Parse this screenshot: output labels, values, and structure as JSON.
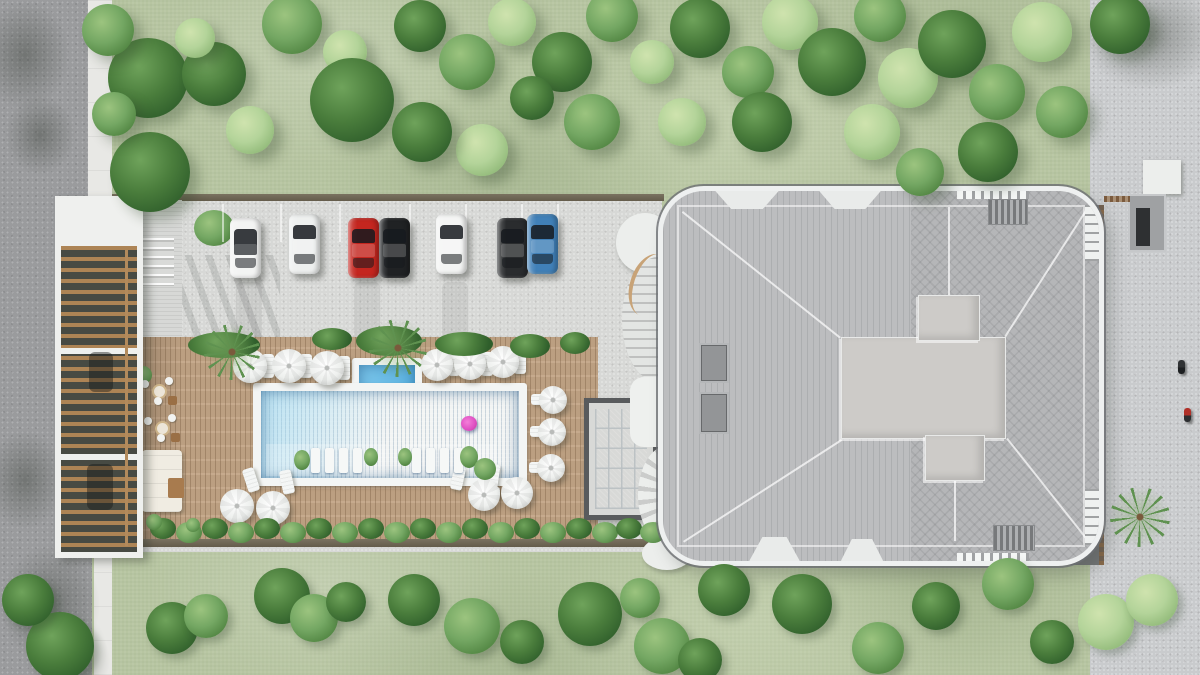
{
  "image": {
    "type": "architectural-aerial-render",
    "title": "residential-complex-site-plan-top-view",
    "width": 1200,
    "height": 675
  },
  "palette": {
    "road": "#9a9b9d",
    "sidewalk": "#e8e8e5",
    "lawn": "#b7c5a1",
    "parking": "#d7d8d6",
    "pavement": "#c9cbcd",
    "deck_wood": "#c3a586",
    "pool_water": "#4aa5d8",
    "pool_coping": "#f3f5f4",
    "kids_pool_water": "#66bbe6",
    "glass_pool": "#4e9bcd",
    "roof": "#bcbdbf",
    "roof_plateau": "#cdcbc8",
    "roof_trim": "#ffffff",
    "pergola_wood": "#ad8455",
    "dark_path": "#747678",
    "tree_dark": "#4a7d3c",
    "tree_mid": "#74a763",
    "tree_light": "#b4d49a",
    "float_pink": "#e052c4"
  },
  "parking": {
    "cars": [
      {
        "name": "white-convertible",
        "color": "#f3f4f3",
        "x": 230,
        "y": 218,
        "open_top": true
      },
      {
        "name": "white-sedan-1",
        "color": "#eef0ef",
        "x": 289,
        "y": 214
      },
      {
        "name": "red-sedan",
        "color": "#c4261f",
        "x": 348,
        "y": 218
      },
      {
        "name": "black-suv-1",
        "color": "#202224",
        "x": 379,
        "y": 218
      },
      {
        "name": "white-sedan-2",
        "color": "#f4f5f4",
        "x": 436,
        "y": 214
      },
      {
        "name": "black-suv-2",
        "color": "#2a2c2e",
        "x": 497,
        "y": 218
      },
      {
        "name": "blue-sedan",
        "color": "#4080b8",
        "x": 527,
        "y": 214
      }
    ],
    "stall_line_xs": [
      222,
      280,
      339,
      409,
      465,
      521,
      557
    ],
    "tire_marks": [
      [
        236,
        282
      ],
      [
        354,
        282
      ],
      [
        442,
        282
      ]
    ]
  },
  "pool_area": {
    "main_pool": {
      "x": 253,
      "y": 383,
      "w": 274,
      "h": 103
    },
    "kids_pool": {
      "x": 352,
      "y": 358,
      "w": 70,
      "h": 52
    },
    "float": {
      "x": 461,
      "y": 416,
      "w": 16,
      "h": 15
    },
    "umbrellas": [
      [
        250,
        366,
        17
      ],
      [
        289,
        366,
        17
      ],
      [
        327,
        368,
        17
      ],
      [
        437,
        365,
        16
      ],
      [
        470,
        364,
        16
      ],
      [
        503,
        362,
        16
      ],
      [
        553,
        400,
        14
      ],
      [
        552,
        432,
        14
      ],
      [
        551,
        468,
        14
      ],
      [
        237,
        506,
        17
      ],
      [
        273,
        508,
        17
      ],
      [
        484,
        495,
        16
      ],
      [
        517,
        493,
        16
      ]
    ],
    "deck_loungers": [
      [
        262,
        354,
        12,
        24,
        0
      ],
      [
        300,
        354,
        12,
        24,
        0
      ],
      [
        338,
        356,
        12,
        24,
        0
      ],
      [
        448,
        352,
        12,
        24,
        0
      ],
      [
        481,
        352,
        12,
        24,
        0
      ],
      [
        514,
        350,
        12,
        24,
        0
      ],
      [
        531,
        394,
        22,
        11,
        0
      ],
      [
        530,
        426,
        22,
        11,
        0
      ],
      [
        529,
        462,
        22,
        11,
        0
      ],
      [
        245,
        468,
        12,
        24,
        -18
      ],
      [
        281,
        470,
        12,
        24,
        -12
      ],
      [
        452,
        466,
        12,
        24,
        12
      ],
      [
        487,
        464,
        12,
        24,
        8
      ],
      [
        478,
        487,
        22,
        11,
        0
      ]
    ],
    "in_pool_lounger_xs": [
      311,
      325,
      339,
      353,
      412,
      426,
      440,
      454
    ],
    "pool_plants": [
      [
        294,
        450,
        16,
        20
      ],
      [
        364,
        448,
        14,
        18
      ],
      [
        398,
        448,
        14,
        18
      ],
      [
        460,
        446,
        18,
        22
      ],
      [
        474,
        458,
        22,
        22
      ]
    ]
  },
  "vegetation": {
    "trees_top": [
      [
        148,
        78,
        40,
        "d"
      ],
      [
        214,
        74,
        32,
        "d"
      ],
      [
        108,
        30,
        26,
        "m"
      ],
      [
        195,
        38,
        20,
        "l"
      ],
      [
        292,
        24,
        30,
        "m"
      ],
      [
        345,
        52,
        22,
        "l"
      ],
      [
        352,
        100,
        42,
        "d"
      ],
      [
        150,
        172,
        40,
        "d"
      ],
      [
        114,
        114,
        22,
        "m"
      ],
      [
        250,
        130,
        24,
        "l"
      ],
      [
        420,
        26,
        26,
        "d"
      ],
      [
        467,
        62,
        28,
        "m"
      ],
      [
        512,
        22,
        24,
        "l"
      ],
      [
        562,
        62,
        30,
        "d"
      ],
      [
        612,
        16,
        26,
        "m"
      ],
      [
        652,
        62,
        22,
        "l"
      ],
      [
        700,
        28,
        30,
        "d"
      ],
      [
        748,
        72,
        26,
        "m"
      ],
      [
        790,
        22,
        28,
        "l"
      ],
      [
        832,
        62,
        34,
        "d"
      ],
      [
        880,
        16,
        26,
        "m"
      ],
      [
        908,
        78,
        30,
        "l"
      ],
      [
        952,
        44,
        34,
        "d"
      ],
      [
        997,
        92,
        28,
        "m"
      ],
      [
        1042,
        32,
        30,
        "l"
      ],
      [
        1062,
        112,
        26,
        "m"
      ],
      [
        988,
        152,
        30,
        "d"
      ],
      [
        872,
        132,
        28,
        "l"
      ],
      [
        920,
        172,
        24,
        "m"
      ],
      [
        762,
        122,
        30,
        "d"
      ],
      [
        682,
        122,
        24,
        "l"
      ],
      [
        592,
        122,
        28,
        "m"
      ],
      [
        532,
        98,
        22,
        "d"
      ],
      [
        482,
        150,
        26,
        "l"
      ],
      [
        422,
        132,
        30,
        "d"
      ],
      [
        1120,
        24,
        30,
        "d"
      ]
    ],
    "bushes_bottom": [
      [
        172,
        628,
        26,
        "d"
      ],
      [
        206,
        616,
        22,
        "m"
      ],
      [
        282,
        596,
        28,
        "d"
      ],
      [
        314,
        618,
        24,
        "m"
      ],
      [
        346,
        602,
        20,
        "d"
      ],
      [
        414,
        600,
        26,
        "d"
      ],
      [
        472,
        626,
        28,
        "m"
      ],
      [
        522,
        642,
        22,
        "d"
      ],
      [
        590,
        614,
        32,
        "d"
      ],
      [
        640,
        598,
        20,
        "m"
      ],
      [
        662,
        646,
        28,
        "m"
      ],
      [
        700,
        660,
        22,
        "d"
      ],
      [
        724,
        590,
        26,
        "d"
      ],
      [
        802,
        604,
        30,
        "d"
      ],
      [
        878,
        648,
        26,
        "m"
      ],
      [
        936,
        606,
        24,
        "d"
      ],
      [
        1008,
        584,
        26,
        "m"
      ],
      [
        1052,
        642,
        22,
        "d"
      ],
      [
        1106,
        622,
        28,
        "l"
      ],
      [
        1152,
        600,
        26,
        "l"
      ],
      [
        60,
        646,
        34,
        "d"
      ],
      [
        28,
        600,
        26,
        "d"
      ]
    ],
    "hedge_top": [
      [
        188,
        332,
        72,
        26
      ],
      [
        312,
        328,
        40,
        22
      ],
      [
        356,
        326,
        66,
        30
      ],
      [
        435,
        332,
        58,
        24
      ],
      [
        510,
        334,
        40,
        24
      ],
      [
        560,
        332,
        30,
        22
      ]
    ],
    "hedge_bottom_xs": [
      150,
      176,
      202,
      228,
      254,
      280,
      306,
      332,
      358,
      384,
      410,
      436,
      462,
      488,
      514,
      540,
      566,
      592,
      616,
      640
    ],
    "palms": [
      [
        232,
        352,
        56
      ],
      [
        398,
        348,
        58
      ],
      [
        1140,
        517,
        60
      ]
    ]
  },
  "shadows": {
    "road_blobs": [
      [
        -20,
        0,
        90,
        110
      ],
      [
        5,
        95,
        70,
        80
      ],
      [
        -15,
        430,
        80,
        100
      ],
      [
        0,
        545,
        100,
        120
      ],
      [
        30,
        620,
        80,
        80
      ],
      [
        1080,
        -20,
        140,
        110
      ]
    ]
  },
  "people": [
    {
      "name": "pedestrian-dark",
      "x": 1178,
      "y": 360,
      "shirt": "#303234",
      "pants": "#1d1f21"
    },
    {
      "name": "pedestrian-red",
      "x": 1184,
      "y": 408,
      "shirt": "#b03028",
      "pants": "#2c2e30"
    }
  ],
  "furniture_left": {
    "tables": [
      [
        152,
        384
      ],
      [
        155,
        421
      ]
    ],
    "chair_offsets": [
      [
        -11,
        -4
      ],
      [
        13,
        -7
      ],
      [
        2,
        13
      ]
    ],
    "stools": [
      [
        168,
        396
      ],
      [
        171,
        433
      ]
    ],
    "sofa": [
      142,
      450,
      40,
      62
    ],
    "wood_table": [
      168,
      478,
      16,
      20
    ],
    "plants": [
      [
        134,
        366,
        18
      ],
      [
        146,
        514,
        16
      ],
      [
        186,
        518,
        14
      ]
    ]
  },
  "building": {
    "skylights": 2,
    "roof_vents": 2,
    "dormers": 4,
    "cross_plateau": true
  },
  "counts": {
    "cars": 7,
    "umbrellas": 13,
    "pools": 3
  }
}
